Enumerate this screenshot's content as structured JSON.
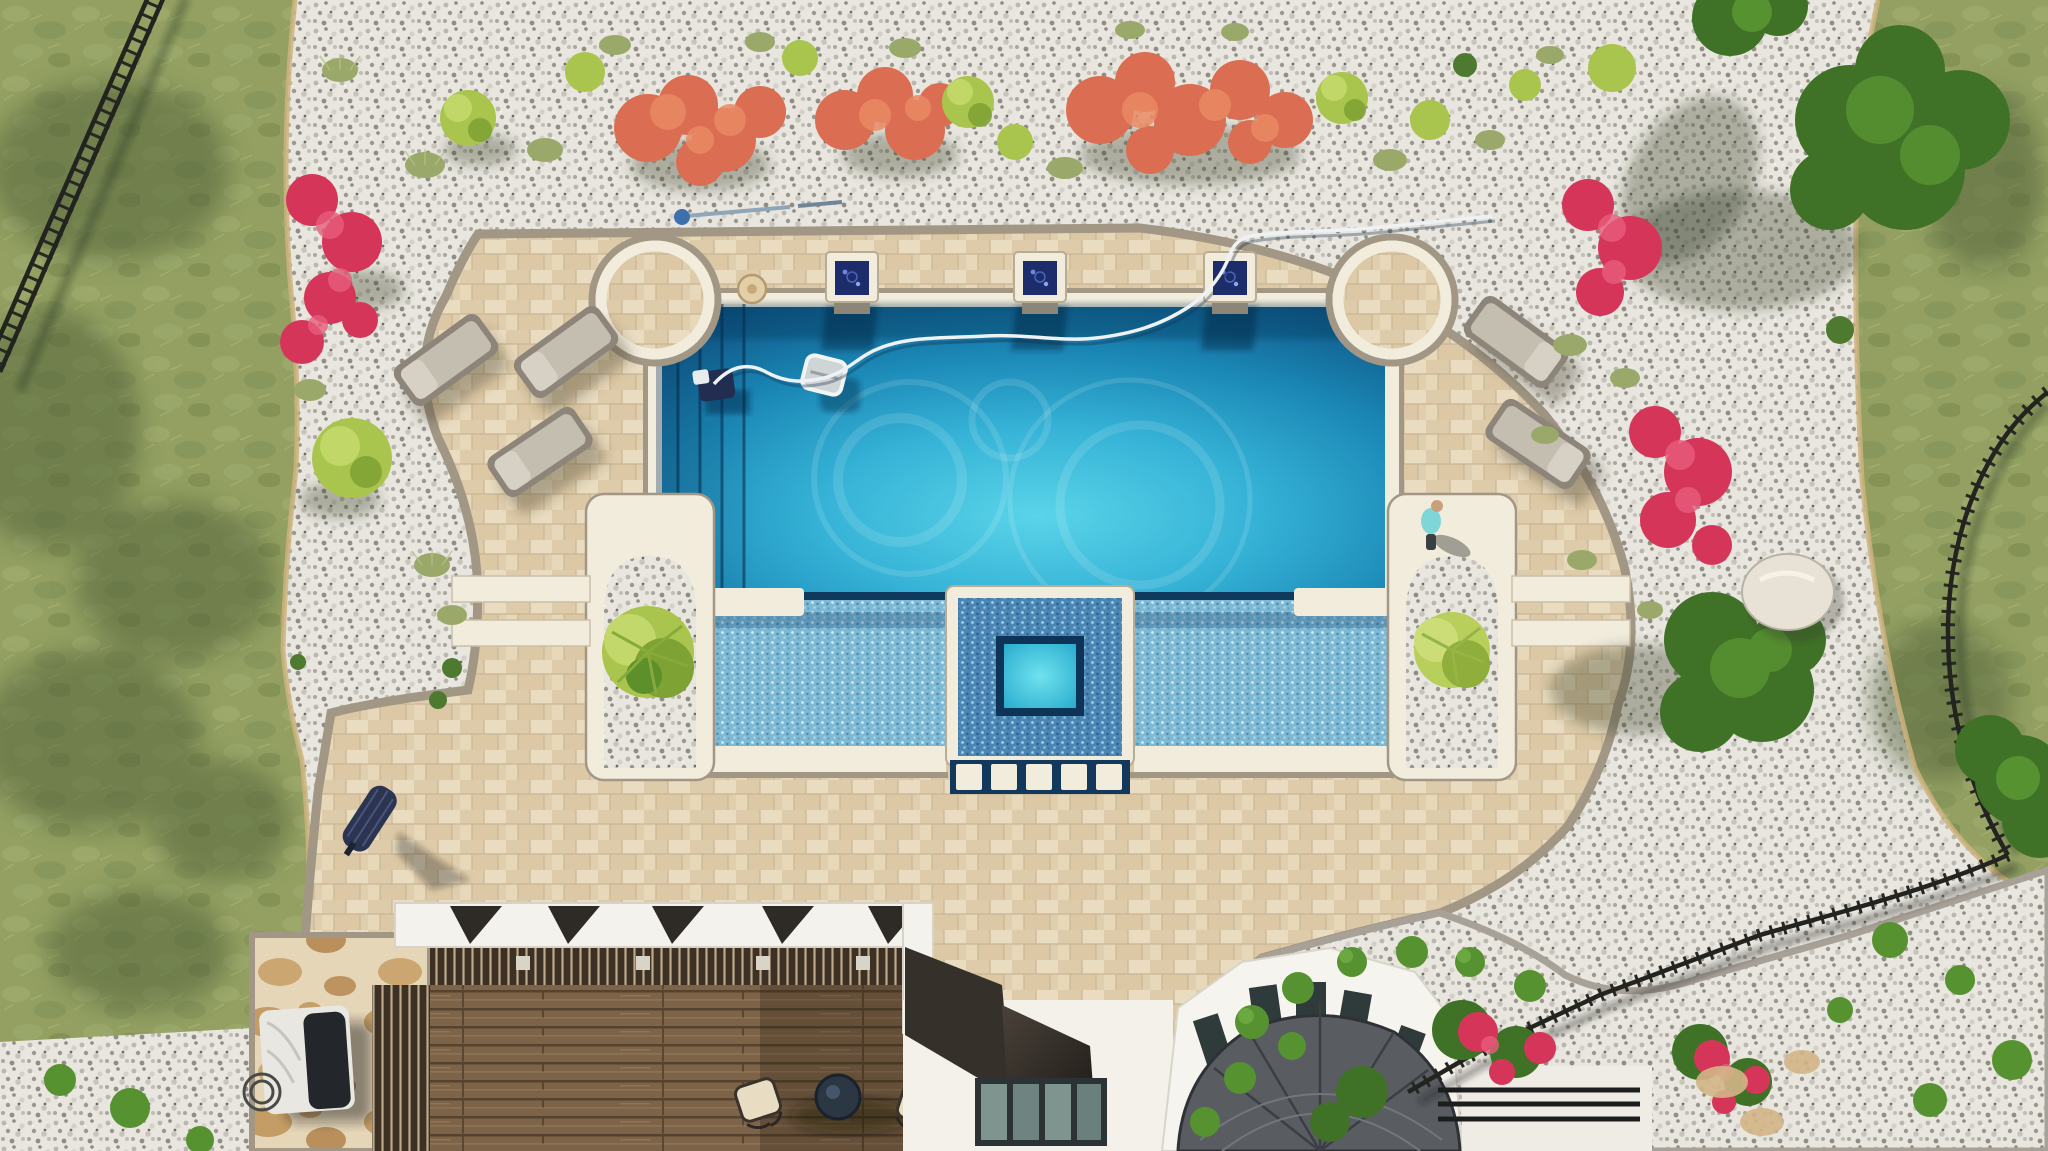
{
  "scene": {
    "type": "aerial-drone-photo",
    "description": "Top-down aerial view of a luxury backyard: large rectangular pool with scalloped corners, tanning ledge and square spa, travertine paver deck, white-gravel planting beds with ornamental grasses and red/coral flowers, lawn with black metal fencing, wood pergola and white house with octagonal shingled bay roof at bottom",
    "time_of_day": "midday-sun"
  },
  "palette": {
    "pool_deep": "#0d4c7c",
    "pool_mid": "#1e8cb8",
    "pool_bright": "#4ecbe4",
    "pool_wall": "#10395e",
    "spa_water": "#3bd0e6",
    "ledge_tile": "#7fb9d4",
    "spa_tile": "#4b86b4",
    "coping": "#f2ecdc",
    "deck_paver": "#e4d4b6",
    "deck_border": "#a29684",
    "gravel": "#e8e6df",
    "lawn": "#93a062",
    "feature_glass": "#1d2d6b",
    "wood": "#7d6347",
    "beam_white": "#f4f2ec",
    "awning_bronze": "#36302a",
    "roof_shingle": "#595d62",
    "house_wall": "#f3f1ea",
    "fence": "#23241f",
    "flower_red": "#d6355a",
    "flower_coral": "#db6e52",
    "plant_lime": "#a9c54d",
    "lounger": "#c4beb0",
    "grill_cover": "#e9e7e1",
    "umbrella": "#2b3450",
    "table": "#2c3744",
    "person_shirt": "#7fd6d8",
    "boulder": "#e8e2d6",
    "curb_tan": "#cdb37e",
    "curb_gray": "#a8a198"
  },
  "objects": {
    "pool": "main swimming pool with left entry steps and three wall-top water features",
    "water_features": [
      "blue-glass fire/water bowl left",
      "blue-glass fire/water bowl center",
      "blue-glass fire/water bowl right"
    ],
    "spa": "square inset spa with blue mosaic surround and five white step pads",
    "tanning_ledge": "shallow tiled shelf between pool and spa",
    "arch_planters": [
      "left arched gravel planter with palm",
      "right arched gravel planter with palm"
    ],
    "loungers": [
      "left lounger 1",
      "left lounger 2",
      "left lounger 3",
      "right lounger 1",
      "right lounger 2"
    ],
    "pool_robot": "robotic pool cleaner with white float and hose",
    "skimmer_pole": "pool skimmer pole on gravel",
    "pergola": "wood-roof pergola with white beams and bistro set",
    "grill": "covered BBQ grill on flagstone pad",
    "umbrella": "closed patio umbrella on deck",
    "person": "person kneeling at pool edge",
    "house": "white house with bronze awning, transom windows and octagonal shingled bay roof",
    "fences": [
      "black fence top-left over lawn",
      "black fence bottom-right around yard",
      "black railing beside bay"
    ]
  }
}
